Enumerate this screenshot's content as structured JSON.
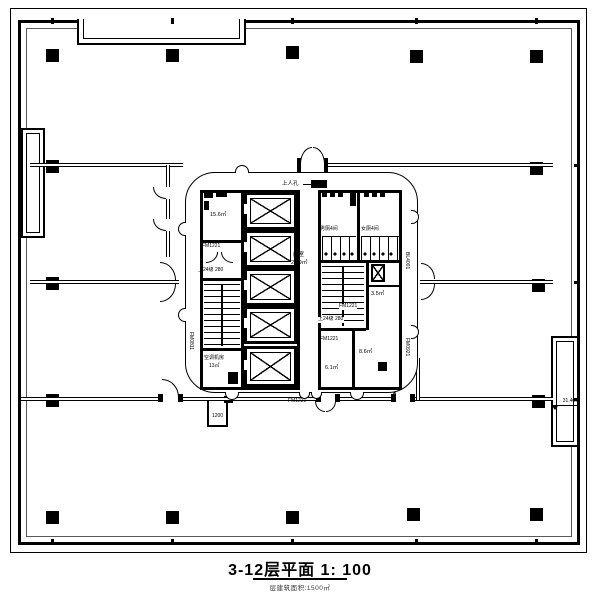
{
  "document": {
    "type": "architectural floor plan",
    "title": "3-12层平面  1: 100",
    "subtitle": "层建筑面积:1500㎡",
    "floors": "3-12",
    "scale": "1: 100"
  },
  "labels": {
    "hatch": "上人孔",
    "room_156": "15.6㎡",
    "door_fm1221": "FM1221",
    "stair_note": "上24级 280",
    "ahu_room": "空调机房",
    "ahu_area": "13㎡",
    "lobby": "前室",
    "lobby_area": "24.9㎡",
    "mens": "男厕4间",
    "womens": "女厕4间",
    "room_35": "3.5㎡",
    "room_61": "6.1㎡",
    "room_86": "8.6㎡",
    "dim_south": "1200",
    "level_mark": "31.400",
    "tag_west": "FM0811",
    "tag_east1": "BL4001",
    "tag_east2": "FM0921"
  },
  "colors": {
    "line": "#000000",
    "paper": "#ffffff"
  }
}
